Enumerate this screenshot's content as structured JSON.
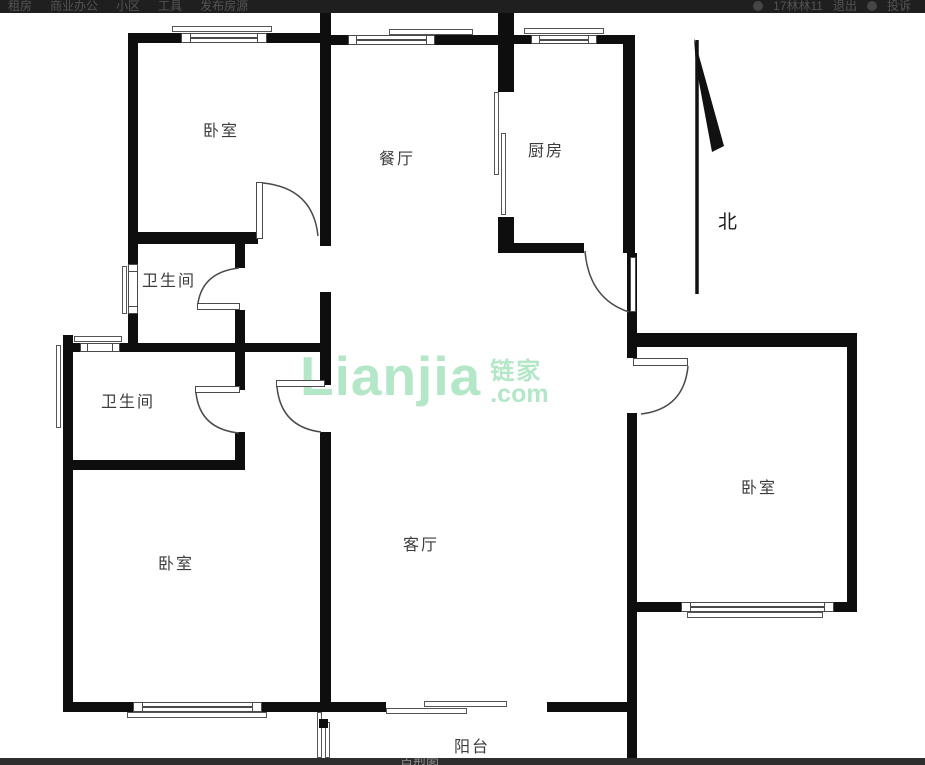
{
  "header": {
    "nav_items": [
      {
        "label": "租房"
      },
      {
        "label": "商业办公"
      },
      {
        "label": "小区"
      },
      {
        "label": "工具"
      },
      {
        "label": "发布房源"
      }
    ],
    "username": "17林林11",
    "logout_label": "退出",
    "complaint_label": "投诉"
  },
  "floorplan": {
    "rooms": [
      {
        "id": "bedroom-nw",
        "label": "卧室"
      },
      {
        "id": "dining",
        "label": "餐厅"
      },
      {
        "id": "kitchen",
        "label": "厨房"
      },
      {
        "id": "bathroom-upper",
        "label": "卫生间"
      },
      {
        "id": "bathroom-lower",
        "label": "卫生间"
      },
      {
        "id": "bedroom-sw",
        "label": "卧室"
      },
      {
        "id": "living",
        "label": "客厅"
      },
      {
        "id": "bedroom-east",
        "label": "卧室"
      },
      {
        "id": "balcony",
        "label": "阳台"
      }
    ],
    "compass_label": "北",
    "watermark": {
      "logo_text": "Lianjia",
      "brand_cn": "链家",
      "domain_suffix": ".com",
      "color": "#b4e7c8"
    }
  },
  "footer": {
    "tab_label": "户型图"
  },
  "colors": {
    "wall": "#0e0e0e",
    "thin_line": "#4a4a4a",
    "label_text": "#3c3c3c",
    "header_bg": "#1f1f1f",
    "footer_bg": "#2e2e2e",
    "watermark": "#b4e7c8"
  }
}
